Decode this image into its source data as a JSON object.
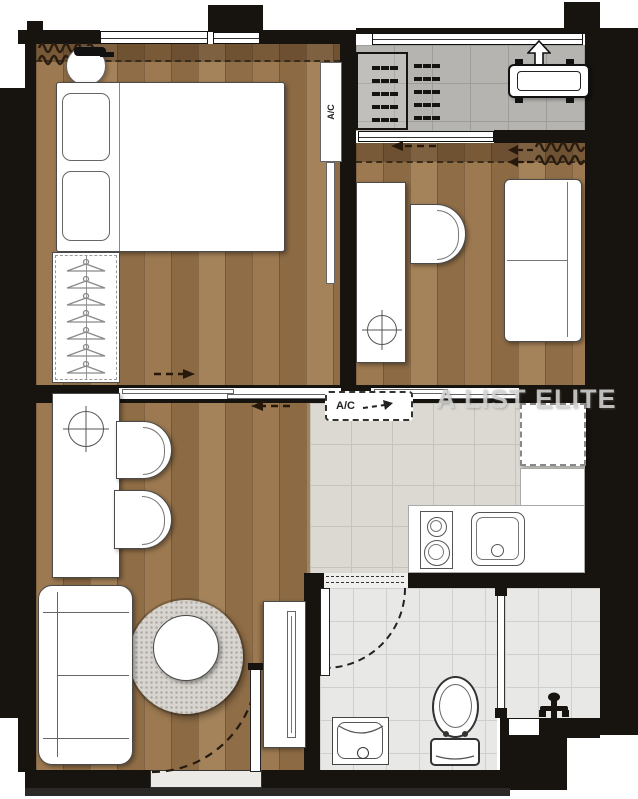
{
  "watermark": "A LIST ELITE",
  "labels": {
    "ac_wall_unit": "A/C",
    "ac_ceiling_unit": "A/C"
  },
  "colors": {
    "wall": "#17130f",
    "wood": "#9a7750",
    "balcony_tile": "#b6b4b0",
    "kitchen_tile": "#dcd9d2",
    "bathroom_tile": "#e8e8e6",
    "rug": "#d8d5d0",
    "furniture": "#ffffff",
    "furniture_outline": "#4a4a4a",
    "watermark_color": "#d7d7d6",
    "bottom_trim": "#2b2927"
  }
}
